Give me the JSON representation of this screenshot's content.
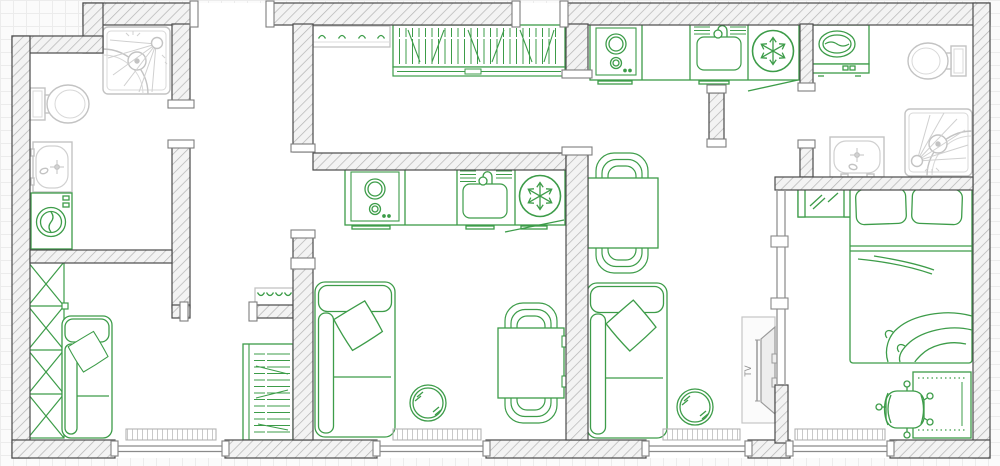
{
  "canvas": {
    "kind": "apartment-floor-plan",
    "width_px": 1000,
    "height_px": 466,
    "background": "graph-paper-grid",
    "interior_fill": "#ffffff"
  },
  "colors": {
    "furniture_green": "#3d9c49",
    "fixture_gray": "#c3c3c3",
    "wall_border": "#4a4a4a",
    "wall_hatch_fill": "#f3f3f3",
    "wall_hatch_line": "#b4b4b4",
    "window_frame_gray": "#8a8a8a",
    "tv_gray": "#909090",
    "grid_line": "#ececec",
    "page_background": "#fbfbfb"
  },
  "labels": {
    "tv": "TV"
  },
  "rooms": [
    {
      "id": "bathroom-left",
      "position": "top-left",
      "fixtures": [
        "corner-shower",
        "toilet",
        "wash-basin",
        "washing-machine"
      ],
      "doors": [
        "door-to-entry"
      ]
    },
    {
      "id": "entry-room",
      "position": "top-left-center",
      "fixtures": [],
      "doors": [
        "entrance-doorway",
        "door-to-living-room-left",
        "passage-to-hallway"
      ]
    },
    {
      "id": "hallway",
      "position": "top-center",
      "fixtures": [
        "coat-rack-hooks",
        "open-wardrobe-hanging-clothes",
        "shoe-rail"
      ],
      "doors": [
        "entrance-doorway-2",
        "door-to-kitchen-living-right"
      ]
    },
    {
      "id": "living-room-left",
      "position": "bottom-left",
      "fixtures": [
        "closet-4-sections",
        "sofa-with-pillow",
        "bookshelf",
        "coat-hooks",
        "radiator",
        "window"
      ]
    },
    {
      "id": "kitchen-living-center",
      "position": "center",
      "fixtures": [
        "cooktop-2-burners",
        "kitchen-counter",
        "kitchen-sink",
        "refrigerator",
        "sofa-with-pillow",
        "pouf",
        "dining-table",
        "chair-top",
        "chair-bottom",
        "radiator",
        "window"
      ]
    },
    {
      "id": "kitchen-living-right",
      "position": "center-right",
      "fixtures": [
        "cooktop-2-burners",
        "kitchen-counter",
        "kitchen-sink",
        "refrigerator",
        "dining-table",
        "chair-top",
        "chair-bottom",
        "sofa-with-pillow",
        "pouf",
        "tv-stand",
        "wall-tv",
        "radiator",
        "window"
      ]
    },
    {
      "id": "bathroom-right",
      "position": "top-right",
      "fixtures": [
        "washing-machine",
        "toilet",
        "wash-basin",
        "corner-shower"
      ]
    },
    {
      "id": "bedroom",
      "position": "bottom-right",
      "fixtures": [
        "mirror-dresser",
        "double-bed-2-pillows-blanket",
        "desk",
        "office-chair",
        "radiator",
        "window"
      ]
    }
  ],
  "openings": {
    "doorways": 8,
    "bottom_wall_windows": 4
  },
  "counts": {
    "sofas": 3,
    "poufs": 2,
    "dining_tables": 2,
    "dining_chairs": 4,
    "refrigerators": 2,
    "cooktops": 2,
    "kitchen_sinks": 2,
    "washing_machines": 2,
    "toilets": 2,
    "wash_basins": 2,
    "corner_showers": 2,
    "radiators": 4,
    "beds": 1,
    "tvs": 1,
    "desks": 1,
    "office_chairs": 1,
    "closets": 1,
    "bookshelves": 2,
    "coat_racks": 2,
    "mirrors": 1
  }
}
